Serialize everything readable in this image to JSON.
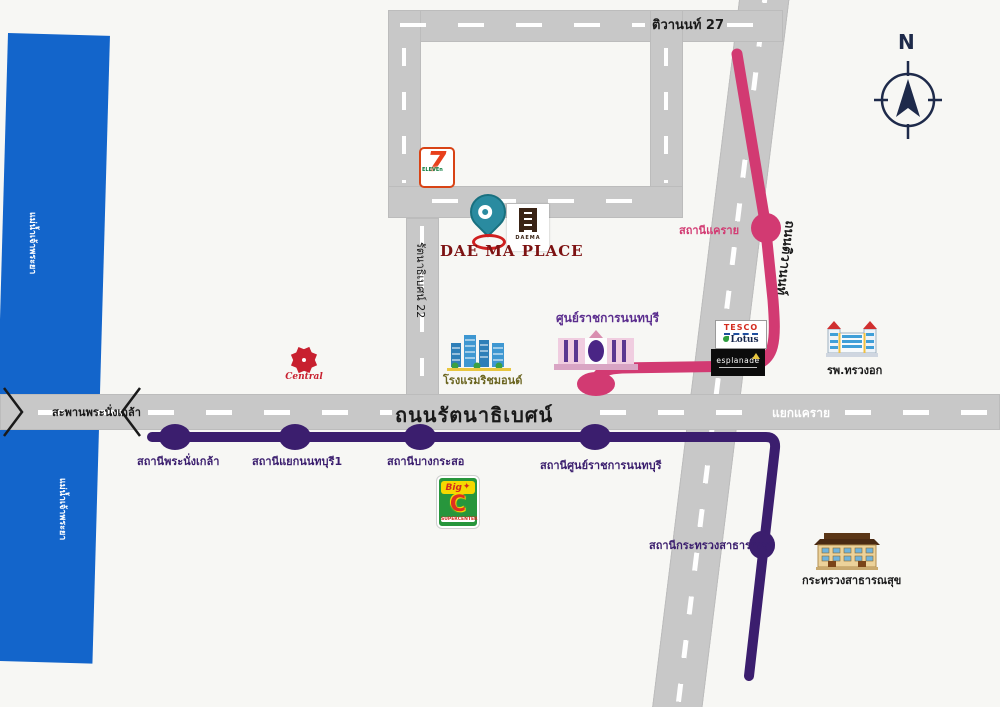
{
  "map": {
    "title": "DAE MA PLACE",
    "compass": {
      "label": "N"
    },
    "colors": {
      "river": "#1365cb",
      "road": "#c8c8c8",
      "pink_line": "#d23a72",
      "purple_line": "#3b1e6e",
      "title_red": "#7d1212",
      "pin_teal": "#2a8ba0"
    },
    "river": {
      "label": "แม่น้ำเจ้าพระยา"
    },
    "roads": {
      "main": {
        "label": "ถนนรัตนาธิเบศน์"
      },
      "bridge": {
        "label": "สะพานพระนั่งเกล้า"
      },
      "intersection": {
        "label": "แยกแคราย"
      },
      "tiwanon": {
        "label": "ถนนติวานนท์"
      },
      "tiwanon27": {
        "label": "ติวานนท์ 27"
      },
      "soi22": {
        "label": "รัตนาธิเบศน์ 22"
      }
    },
    "pink_line": {
      "stations": [
        {
          "label": "สถานีแคราย"
        }
      ]
    },
    "purple_line": {
      "stations": [
        {
          "label": "สถานีพระนั่งเกล้า"
        },
        {
          "label": "สถานีแยกนนทบุรี1"
        },
        {
          "label": "สถานีบางกระสอ"
        },
        {
          "label": "สถานีศูนย์ราชการนนทบุรี"
        },
        {
          "label": "สถานีกระทรวงสาธารณสุข"
        }
      ]
    },
    "landmarks": {
      "seven_eleven": {
        "big": "7",
        "sub": "ELEVEn"
      },
      "daema": {
        "title": "DAE MA PLACE",
        "logo_text": "DAEMA"
      },
      "central": {
        "label": "Central"
      },
      "richmond": {
        "label": "โรงแรมริชมอนด์"
      },
      "gov_center": {
        "label": "ศูนย์ราชการนนทบุรี"
      },
      "tesco": {
        "line1": "TESCO",
        "line2": "Lotus"
      },
      "esplanade": {
        "label": "esplanade"
      },
      "chest_hospital": {
        "label": "รพ.ทรวงอก"
      },
      "bigc": {
        "big": "Big",
        "c": "C",
        "star": "✦",
        "sub": "SUPERCENTER"
      },
      "moph": {
        "label": "กระทรวงสาธารณสุข"
      }
    }
  }
}
